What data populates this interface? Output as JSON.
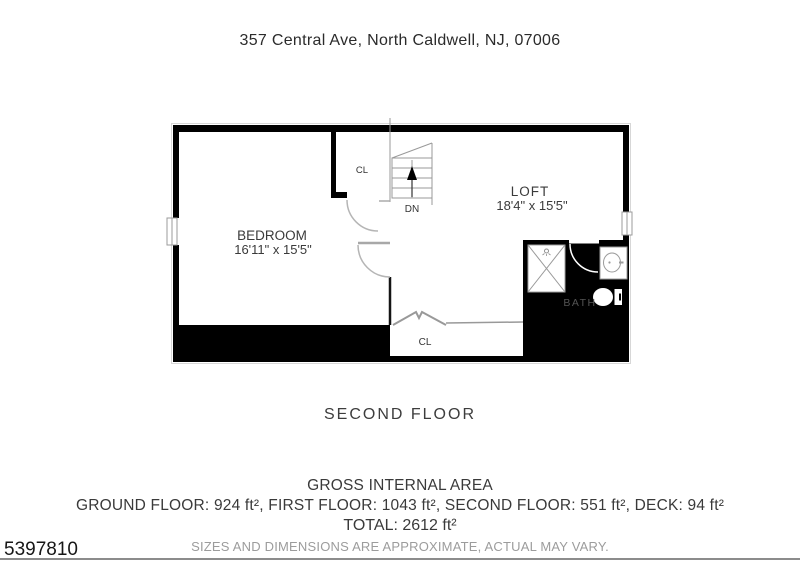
{
  "page": {
    "title": "357 Central Ave, North Caldwell, NJ, 07006",
    "floor_label": "SECOND FLOOR",
    "listing_id": "5397810"
  },
  "floor_plan": {
    "bedroom": {
      "name": "BEDROOM",
      "dims": "16'11\" x 15'5\""
    },
    "loft": {
      "name": "LOFT",
      "dims": "18'4\" x 15'5\""
    },
    "bath": {
      "name": "BATH"
    },
    "closet_top": "CL",
    "closet_bottom": "CL",
    "stairs_label": "DN"
  },
  "area_summary": {
    "heading": "GROSS INTERNAL AREA",
    "breakdown": "GROUND FLOOR: 924 ft², FIRST FLOOR: 1043 ft², SECOND FLOOR: 551 ft², DECK: 94 ft²",
    "total": "TOTAL: 2612 ft²",
    "disclaimer": "SIZES AND DIMENSIONS ARE APPROXIMATE, ACTUAL MAY VARY."
  },
  "colors": {
    "wall_black": "#000000",
    "plan_line_gray": "#999999",
    "door_arc_gray": "#b5b5b5",
    "disclaimer_gray": "#9c9c9c"
  }
}
